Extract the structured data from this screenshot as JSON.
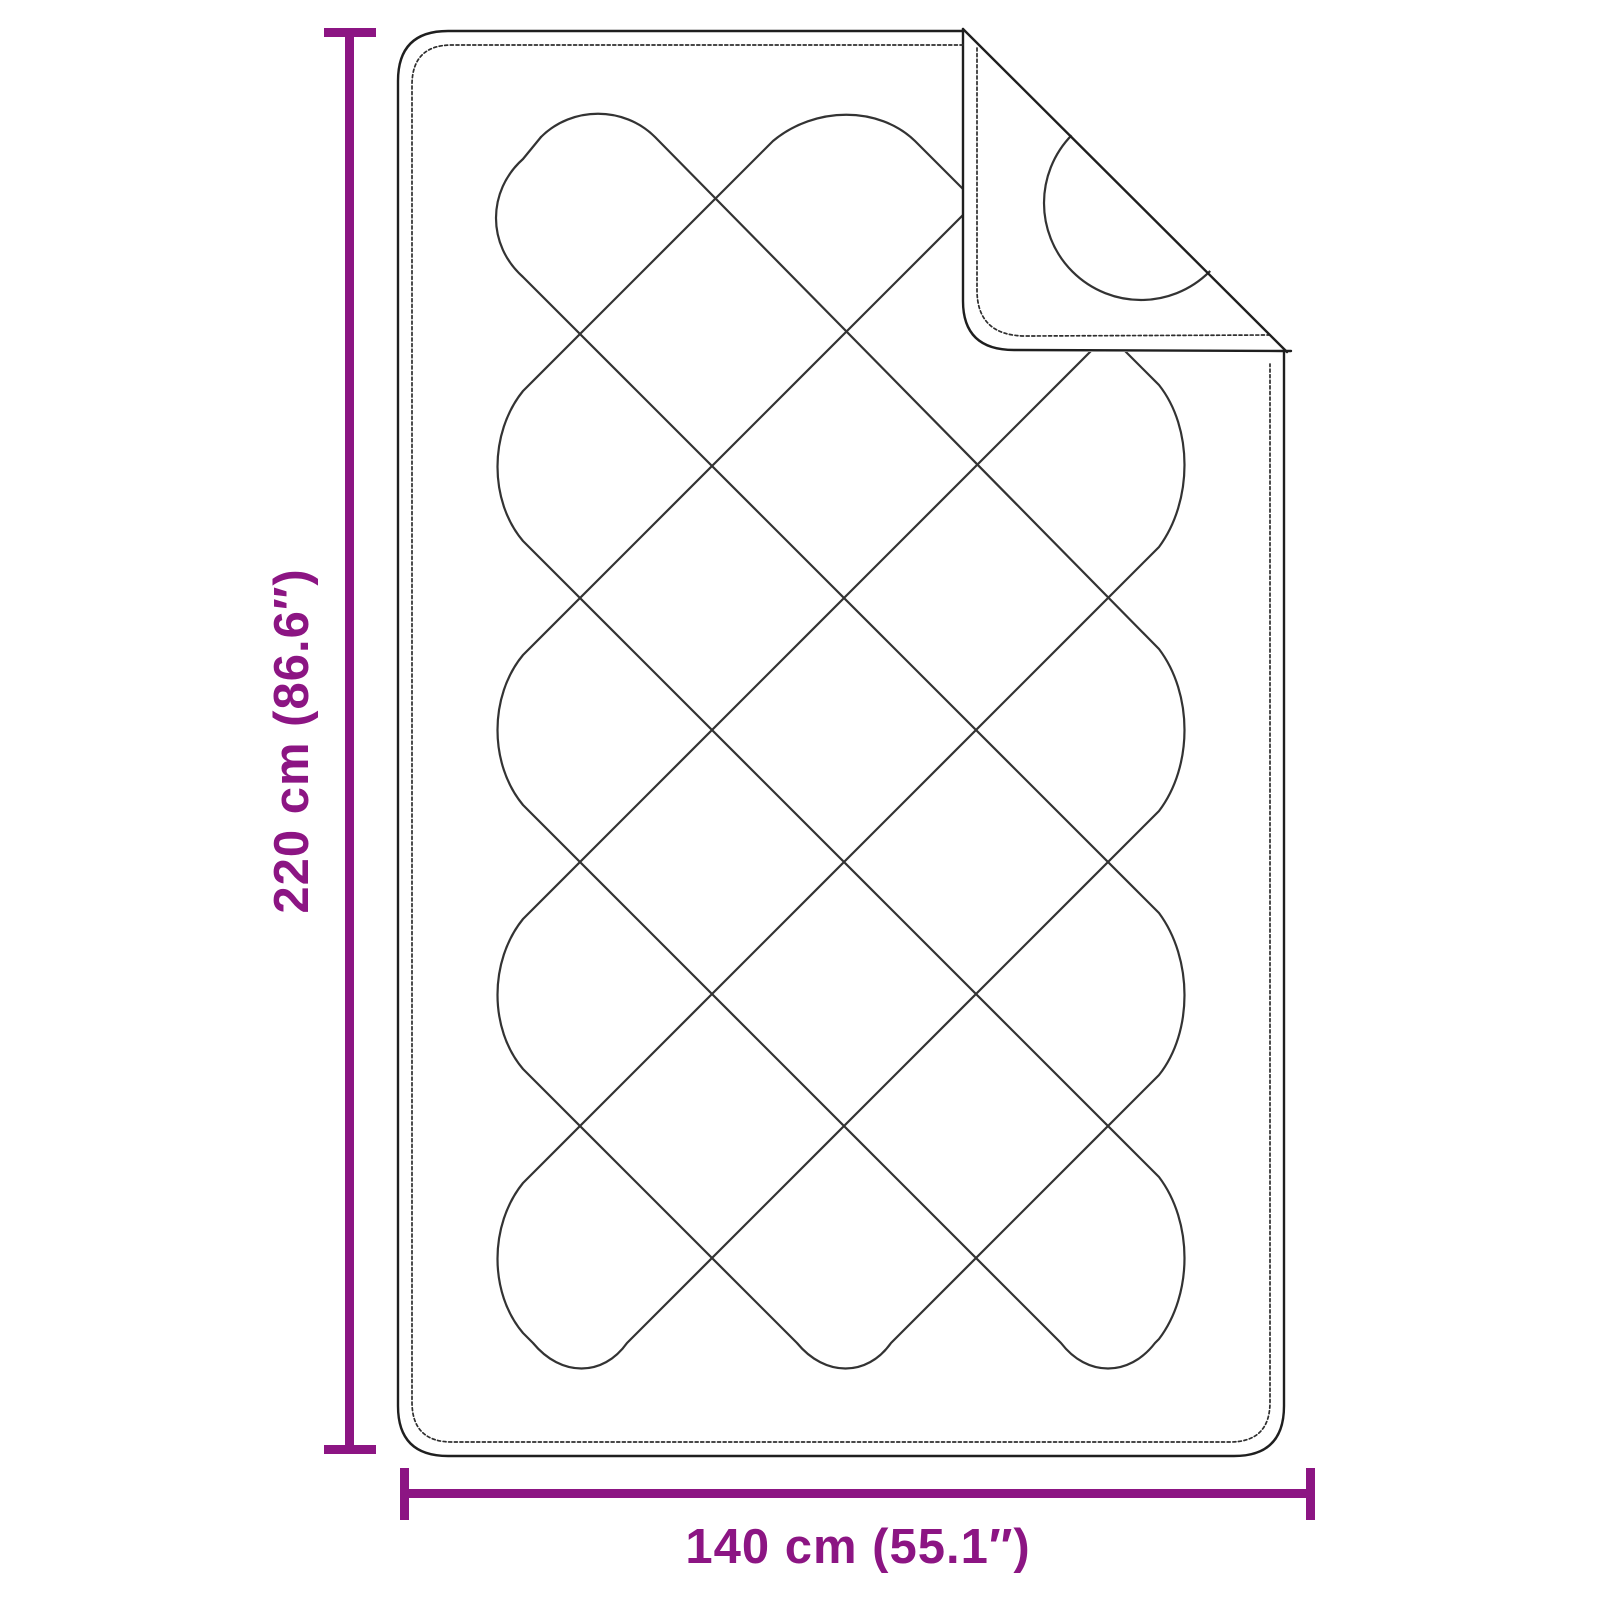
{
  "diagram": {
    "item": "quilted-blanket-dimension-diagram",
    "background_color": "#FFFFFF",
    "outline_color": "#333333",
    "accent_color": "#8C1583",
    "height_dimension": {
      "label": "220 cm (86.6″)",
      "value_cm": "220",
      "value_inches": "86.6",
      "orientation": "vertical"
    },
    "width_dimension": {
      "label": "140 cm (55.1″)",
      "value_cm": "140",
      "value_inches": "55.1",
      "orientation": "horizontal"
    }
  }
}
